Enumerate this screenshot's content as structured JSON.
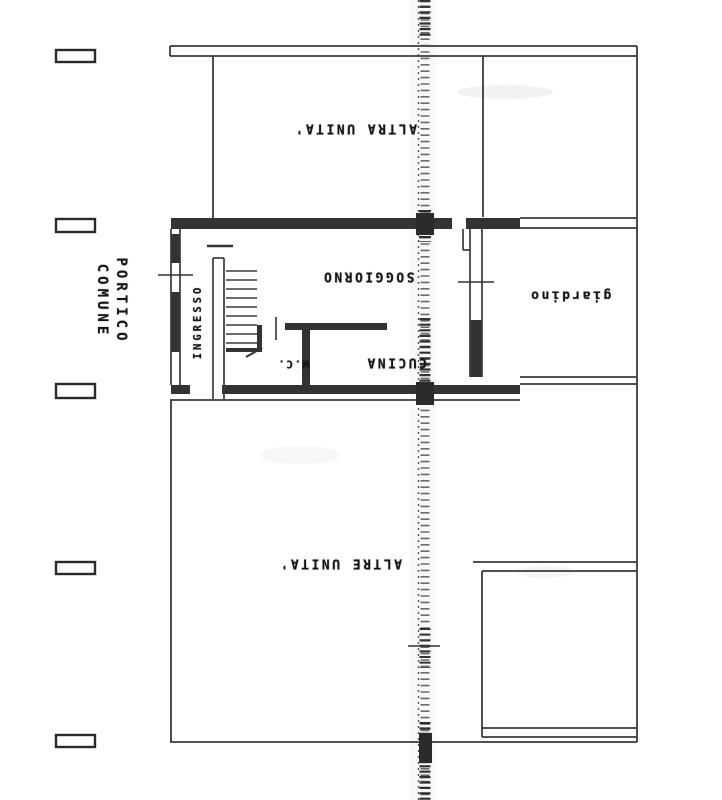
{
  "colors": {
    "ink": "#373737",
    "label_ink": "#161616",
    "paper": "#ffffff"
  },
  "labels": {
    "altra_unita": "ALTRA UNITA'",
    "soggiorno": "SOGGIORNO",
    "cucina": "CUCINA",
    "wc": "W.C.",
    "ingresso": "INGRESSO",
    "giardino": "giardino",
    "altre_unita": "ALTRE UNITA'",
    "portico_line1": "PORTICO",
    "portico_line2": "COMUNE"
  }
}
